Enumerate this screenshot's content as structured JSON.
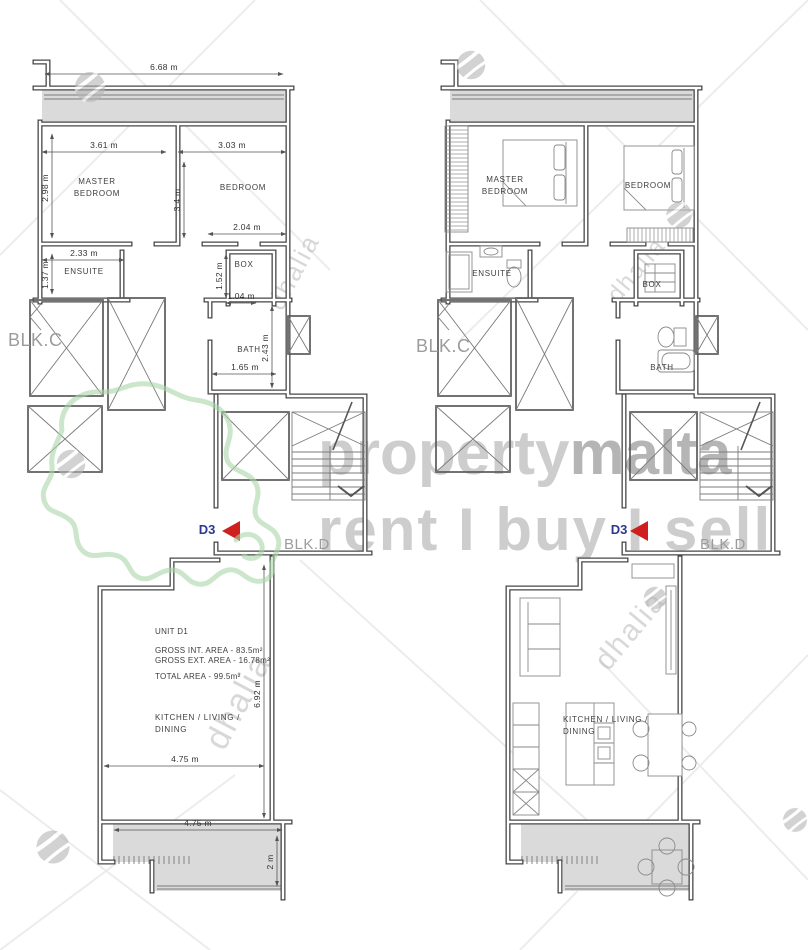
{
  "watermark": {
    "brand_light": "property",
    "brand_dark": "malta",
    "tagline": "rent I buy I sell",
    "agency": "dhalia"
  },
  "common_labels": {
    "blk_c": "BLK.C",
    "blk_d": "BLK.D",
    "unit_marker": "D3"
  },
  "left_plan": {
    "rooms": {
      "master_1": "MASTER",
      "master_2": "BEDROOM",
      "bedroom": "BEDROOM",
      "ensuite": "ENSUITE",
      "box": "BOX",
      "bath": "BATH",
      "kitchen_1": "KITCHEN / LIVING /",
      "kitchen_2": "DINING"
    },
    "unit_info": {
      "unit": "UNIT D1",
      "gross_internal": "GROSS INT. AREA - 83.5m²",
      "gross_external": "GROSS EXT. AREA - 16.78m²",
      "total": "TOTAL AREA - 99.5m²"
    },
    "dimensions": {
      "top_width": "6.68 m",
      "master_width": "3.61 m",
      "bedroom_width": "3.03 m",
      "master_depth": "2.98 m",
      "partition_depth": "3.4 m",
      "bedroom_lower_width": "2.04 m",
      "ensuite_width": "2.33 m",
      "ensuite_depth": "1.37 m",
      "box_depth": "1.52 m",
      "box_width": "1.04 m",
      "bath_depth": "2.43 m",
      "bath_width": "1.65 m",
      "living_depth": "6.92 m",
      "living_width": "4.75 m",
      "terrace_width": "4.75 m",
      "terrace_depth": "2 m"
    }
  },
  "right_plan": {
    "rooms": {
      "master_1": "MASTER",
      "master_2": "BEDROOM",
      "bedroom": "BEDROOM",
      "ensuite": "ENSUITE",
      "box": "BOX",
      "bath": "BATH",
      "kitchen_1": "KITCHEN / LIVING /",
      "kitchen_2": "DINING"
    }
  }
}
